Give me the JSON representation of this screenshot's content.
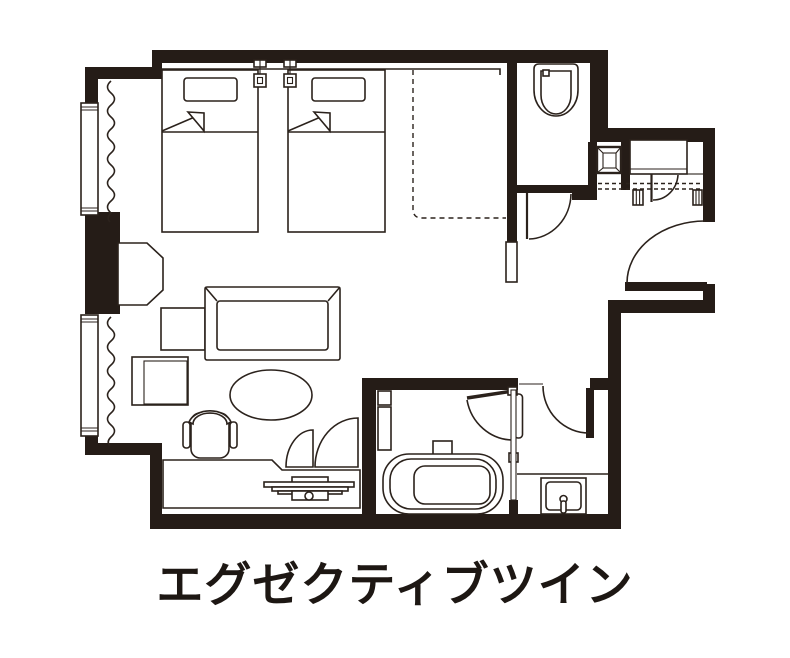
{
  "title": {
    "text": "エグゼクティブツイン"
  },
  "colors": {
    "wall": "#251c17",
    "line": "#2b221c",
    "background": "#ffffff",
    "text": "#1d1713"
  },
  "floor_plan": {
    "room_type_label": "エグゼクティブツイン",
    "fixtures": [
      "twin-bed-left",
      "twin-bed-right",
      "pillow",
      "blanket-fold",
      "reading-light",
      "window-upper",
      "window-lower",
      "curtain",
      "lounge-chair",
      "side-table",
      "cube-table",
      "sofa",
      "oval-coffee-table",
      "desk-chair",
      "desk-counter",
      "tv-on-desk",
      "closet-double-doors",
      "luggage-space-dashed",
      "toilet",
      "toilet-door",
      "stool",
      "entrance-closet",
      "entrance-shelf-dashed",
      "slippers",
      "entrance-door",
      "bathtub",
      "bath-faucet",
      "bathroom-door",
      "glass-partition",
      "vanity-counter",
      "sink",
      "washroom-door",
      "wall-opening"
    ]
  }
}
